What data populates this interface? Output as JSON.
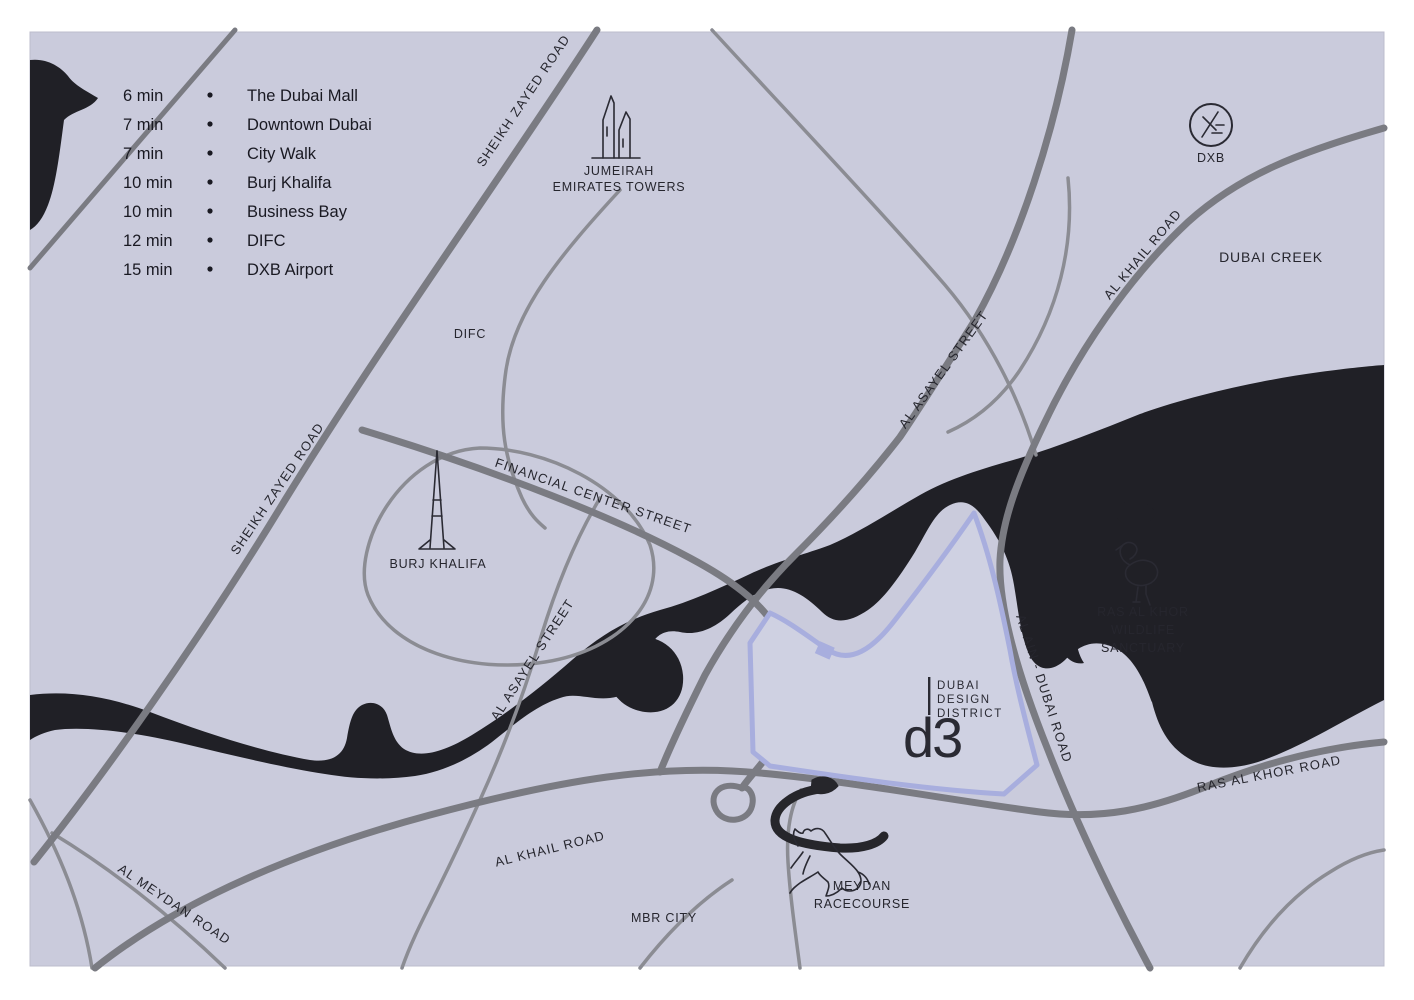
{
  "colors": {
    "map_background": "#cacbdc",
    "district_fill": "#cfd1e2",
    "district_outline": "#a8aede",
    "water": "#202026",
    "road_major": "#7a7b82",
    "road_minor": "#8b8c93",
    "text": "#23232b"
  },
  "legend": {
    "items": [
      {
        "time": "6 min",
        "label": "The Dubai Mall"
      },
      {
        "time": "7 min",
        "label": "Downtown Dubai"
      },
      {
        "time": "7 min",
        "label": "City Walk"
      },
      {
        "time": "10 min",
        "label": "Burj Khalifa"
      },
      {
        "time": "10 min",
        "label": "Business Bay"
      },
      {
        "time": "12 min",
        "label": "DIFC"
      },
      {
        "time": "15 min",
        "label": "DXB Airport"
      }
    ]
  },
  "roads": {
    "sheikh_zayed": "SHEIKH ZAYED ROAD",
    "financial_center": "FINANCIAL CENTER STREET",
    "al_asayel": "AL ASAYEL STREET",
    "al_khail": "AL KHAIL ROAD",
    "al_ain_dubai": "AL AIN - DUBAI ROAD",
    "ras_al_khor": "RAS AL KHOR ROAD",
    "al_meydan": "AL MEYDAN ROAD"
  },
  "places": {
    "difc": "DIFC",
    "jumeirah_line1": "JUMEIRAH",
    "jumeirah_line2": "EMIRATES TOWERS",
    "burj_khalifa": "BURJ KHALIFA",
    "dubai_creek": "DUBAI CREEK",
    "dxb": "DXB",
    "sanctuary_line1": "RAS AL KHOR",
    "sanctuary_line2": "WILDLIFE",
    "sanctuary_line3": "SANCTUARY",
    "meydan_line1": "MEYDAN",
    "meydan_line2": "RACECOURSE",
    "mbr_city": "MBR CITY"
  },
  "d3_logo": {
    "line1": "DUBAI",
    "line2": "DESIGN",
    "line3": "DISTRICT",
    "mark": "d3"
  }
}
